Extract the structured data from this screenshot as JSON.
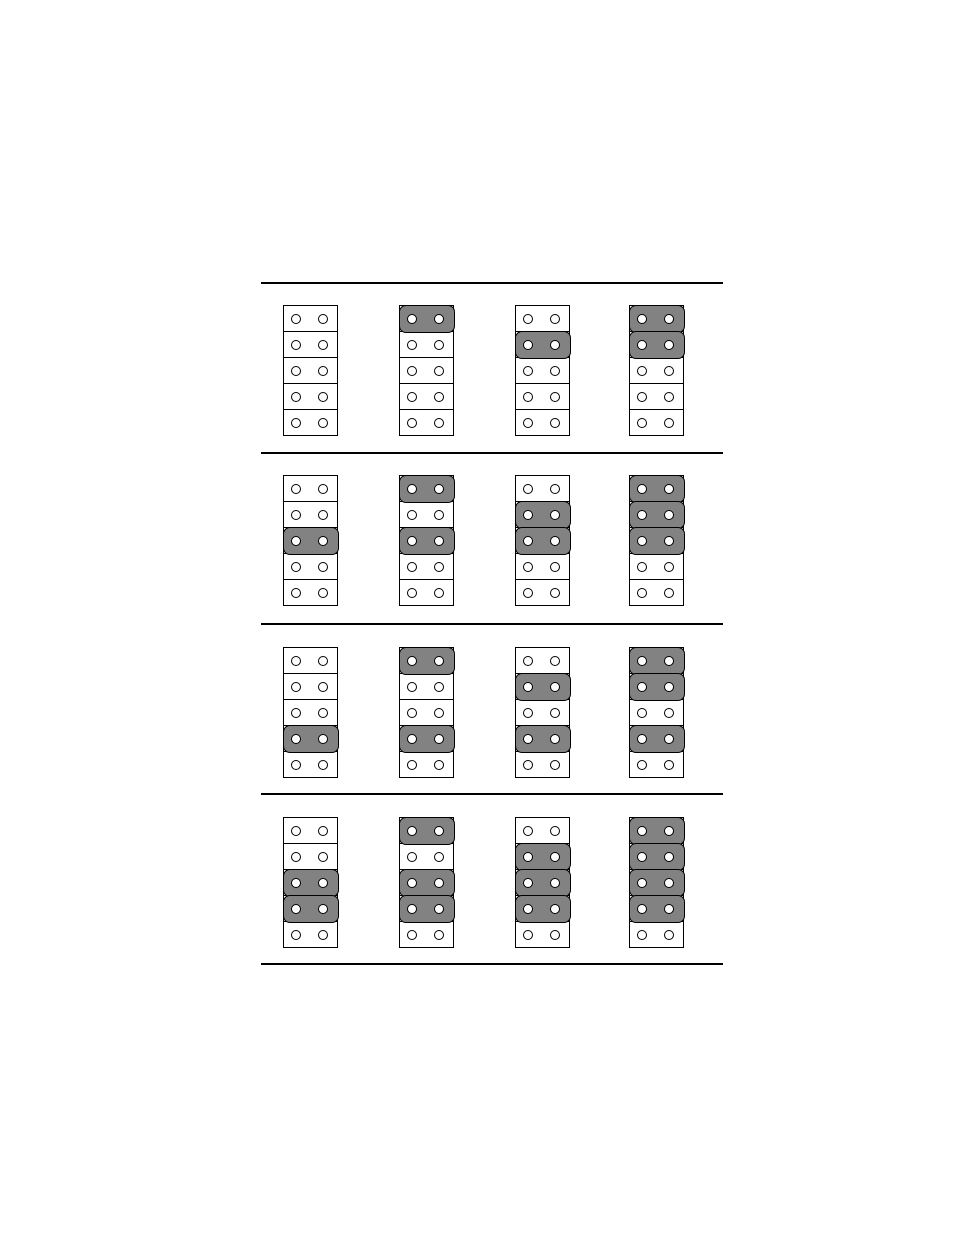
{
  "page": {
    "background": "#ffffff"
  },
  "jumper_diagram": {
    "positions_per_block": 5,
    "pins_per_position": 2,
    "rows": [
      {
        "blocks": [
          {
            "capped_positions": []
          },
          {
            "capped_positions": [
              1
            ]
          },
          {
            "capped_positions": [
              2
            ]
          },
          {
            "capped_positions": [
              1,
              2
            ]
          }
        ]
      },
      {
        "blocks": [
          {
            "capped_positions": [
              3
            ]
          },
          {
            "capped_positions": [
              1,
              3
            ]
          },
          {
            "capped_positions": [
              2,
              3
            ]
          },
          {
            "capped_positions": [
              1,
              2,
              3
            ]
          }
        ]
      },
      {
        "blocks": [
          {
            "capped_positions": [
              4
            ]
          },
          {
            "capped_positions": [
              1,
              4
            ]
          },
          {
            "capped_positions": [
              2,
              4
            ]
          },
          {
            "capped_positions": [
              1,
              2,
              4
            ]
          }
        ]
      },
      {
        "blocks": [
          {
            "capped_positions": [
              3,
              4
            ]
          },
          {
            "capped_positions": [
              1,
              3,
              4
            ]
          },
          {
            "capped_positions": [
              2,
              3,
              4
            ]
          },
          {
            "capped_positions": [
              1,
              2,
              3,
              4
            ]
          }
        ]
      }
    ],
    "colors": {
      "cap_fill": "#828282",
      "outline": "#000000",
      "pin_fill": "#ffffff",
      "page_background": "#ffffff"
    }
  }
}
